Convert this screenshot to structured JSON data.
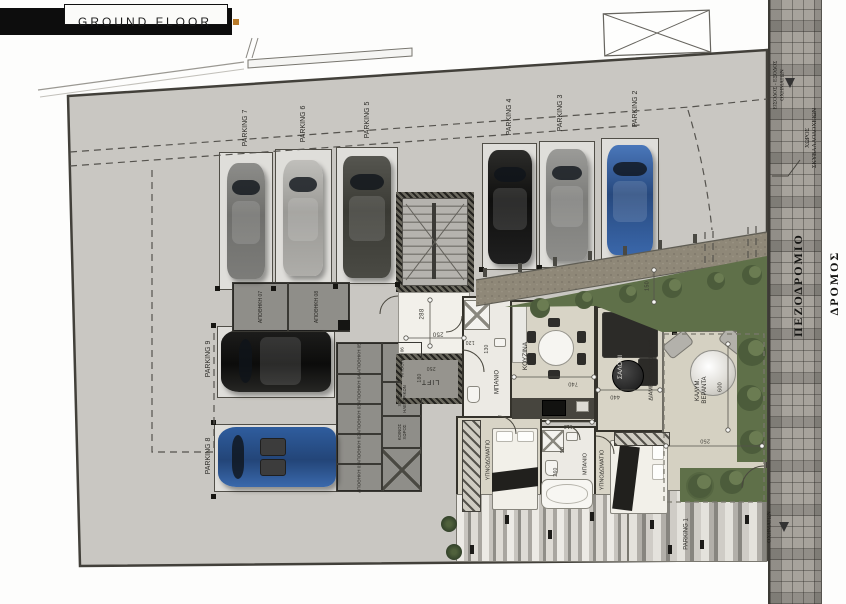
{
  "title": {
    "text": "GROUND FLOOR"
  },
  "palette": {
    "plot_gray": "#c9c7c2",
    "floor_beige": "#d8d4c6",
    "wall_dark": "#34322b",
    "green": "#5f7049",
    "accent_orange": "#b97b2a",
    "car_blue": "#3a67aa"
  },
  "parking": {
    "spots": [
      {
        "label": "PARKING 7"
      },
      {
        "label": "PARKING 6"
      },
      {
        "label": "PARKING 5"
      },
      {
        "label": "PARKING 4"
      },
      {
        "label": "PARKING 3"
      },
      {
        "label": "PARKING 2"
      },
      {
        "label": "PARKING 9"
      },
      {
        "label": "PARKING 8"
      },
      {
        "label": "PARKING 1"
      }
    ]
  },
  "core": {
    "lift": "LIFT"
  },
  "storage": {
    "s01": "ΑΠΟΘΗΚΗ 01",
    "s02": "ΑΠΟΘΗΚΗ 02",
    "s03": "ΑΠΟΘΗΚΗ 03",
    "s04": "ΑΠΟΘΗΚΗ 04",
    "s05": "ΑΠΟΘΗΚΗ 05",
    "s06": "ΑΠΟΘΗΚΗ 06",
    "s07": "ΑΠΟΘΗΚΗ 07",
    "s08": "ΑΠΟΘΗΚΗ 08",
    "electrical": "ΧΩΡΟΣ\nΗΛΕΚΤΡΙΚΩΝ",
    "common": "ΚΟΙΝΟΣ\nΧΩΡΟΣ"
  },
  "apartment": {
    "unit": "ΔΙΑΜΕΡΙΣΜΑ 001 79 M2",
    "kitchen": "ΚΟΥΖΙΝΑ",
    "living": "ΣΑΛΟΝΙ",
    "bath1": "ΜΠΑΝΙΟ",
    "bath2": "ΜΠΑΝΙΟ",
    "bedroom1": "ΥΠΝΟΔΩΜΑΤΙΟ",
    "bedroom2": "ΥΠΝΟΔΩΜΑΤΙΟ",
    "veranda": "ΚΑΛΥΜ.\nΒΕΡΑΝΤΑ"
  },
  "dims": {
    "stair_depth": "288",
    "stair_width": "250",
    "lift_width": "250",
    "lift_depth": "180",
    "hall_a": "120",
    "hall_b": "130",
    "kitchen_len": "740",
    "living_len": "440",
    "bath2_door": "110",
    "bath2_len": "260",
    "bath2_w": "90",
    "veranda_len": "600",
    "veranda_depth": "250",
    "drive_width": "150"
  },
  "street": {
    "sidewalk": "ΠΕΖΟΔΡΟΜΙΟ",
    "road": "ΔΡΟΜΟΣ",
    "vehicle_access": "ΕΙΣΟΔΟΣ - ΕΞΟΔΟΣ\nΟΧΗΜΑΤΩΝ",
    "bins": "ΧΩΡΟΣ\nΣΚΥΒΑΛΛΟΔΟΧΕΙΩΝ",
    "vehicle_access_2": "ΟΧΗΜΑΤΩΝ"
  }
}
